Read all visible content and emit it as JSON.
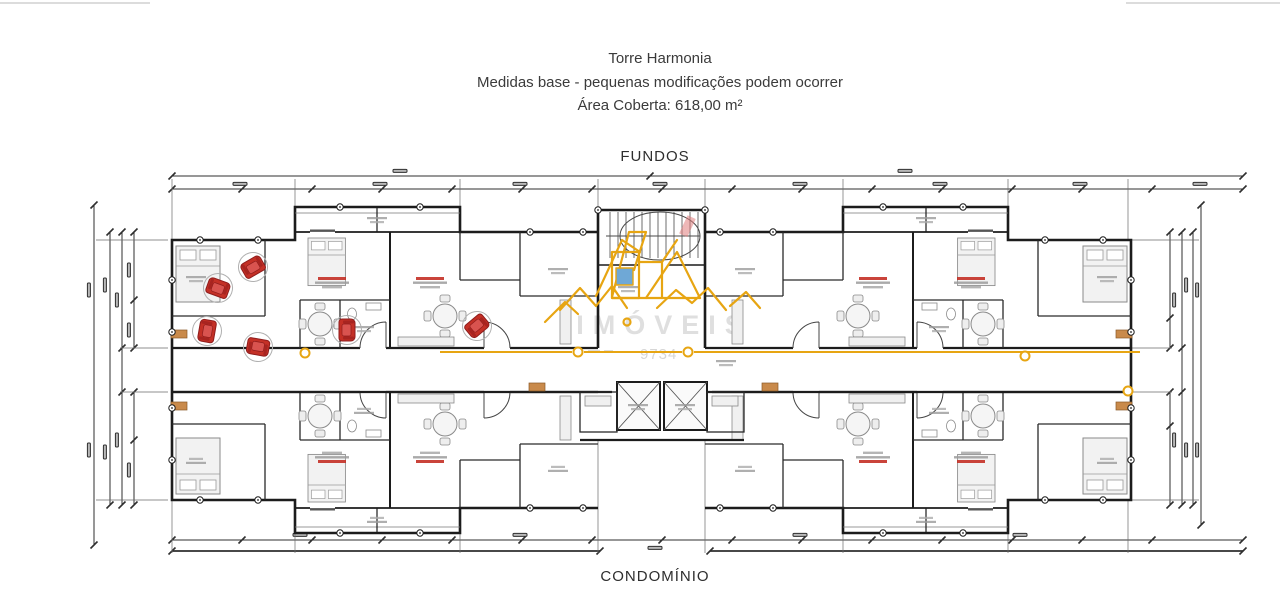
{
  "header": {
    "title": "Torre Harmonia",
    "subtitle": "Medidas base - pequenas modificações podem ocorrer",
    "area": "Área Coberta: 618,00 m²"
  },
  "plan": {
    "top_label": "FUNDOS",
    "bottom_label": "CONDOMÍNIO"
  },
  "watermark": {
    "company_text": "IMÓVEIS",
    "phone_digits": "9734",
    "logo_color": "#E7A512"
  },
  "colors": {
    "wall": "#1c1c1c",
    "dimension": "#2f2f2f",
    "furniture": "#8a8a8a",
    "accent_red": "#c43026",
    "accent_gold": "#E7A512",
    "accent_tan": "#c98a4b",
    "accent_blue": "#6fa8d6"
  }
}
